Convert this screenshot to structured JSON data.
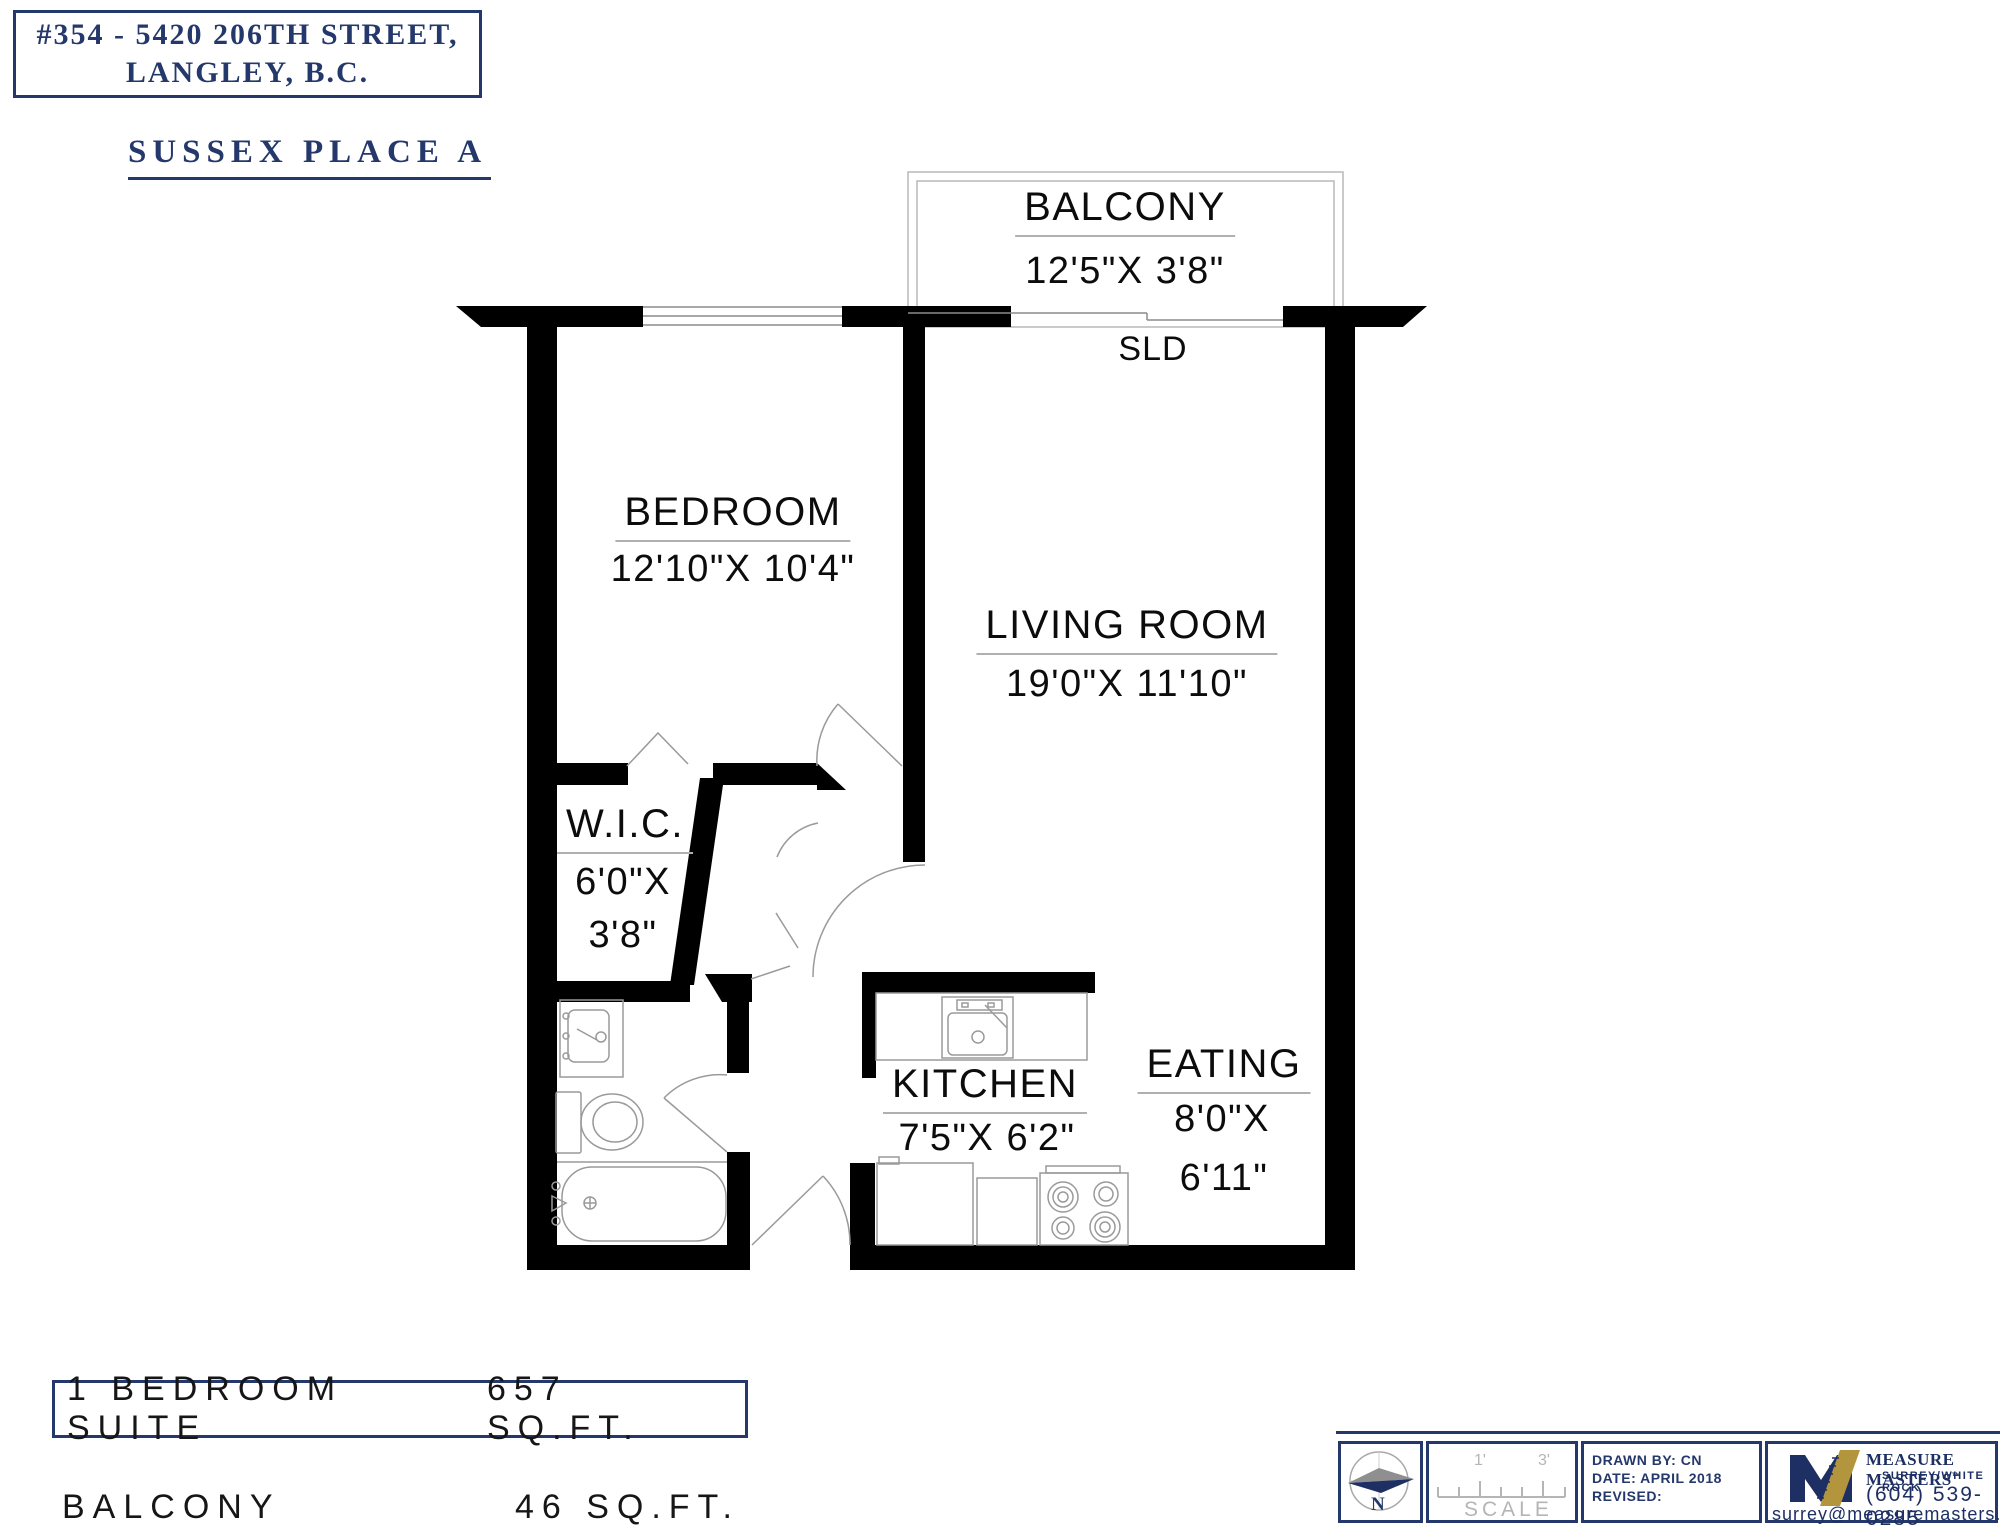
{
  "header": {
    "address_line1": "#354 - 5420 206TH STREET,",
    "address_line2": "LANGLEY, B.C.",
    "subtitle": "SUSSEX PLACE A"
  },
  "rooms": {
    "balcony": {
      "name": "BALCONY",
      "dims": "12'5\"X  3'8\""
    },
    "sld_label": "SLD",
    "bedroom": {
      "name": "BEDROOM",
      "dims": "12'10\"X  10'4\""
    },
    "living": {
      "name": "LIVING ROOM",
      "dims": "19'0\"X  11'10\""
    },
    "wic": {
      "name": "W.I.C.",
      "dims_line1": "6'0\"X",
      "dims_line2": "3'8\""
    },
    "kitchen": {
      "name": "KITCHEN",
      "dims": "7'5\"X  6'2\""
    },
    "eating": {
      "name": "EATING",
      "dims_line1": "8'0\"X",
      "dims_line2": "6'11\""
    }
  },
  "summary": {
    "suite_label": "1 BEDROOM SUITE",
    "suite_area": "657 SQ.FT.",
    "balcony_label": "BALCONY",
    "balcony_area": "46 SQ.FT."
  },
  "titleblock": {
    "compass_n": "N",
    "scale_tick1": "1'",
    "scale_tick2": "3'",
    "scale_label": "SCALE",
    "drawn_by": "DRAWN BY: CN",
    "date": "DATE: APRIL 2018",
    "revised": "REVISED:",
    "logo_name": "MEASURE MASTERS",
    "logo_tm": "™",
    "logo_sub": "SURREY/WHITE ROCK",
    "logo_phone": "(604) 539-0285",
    "logo_email": "surrey@measuremasters.ca"
  },
  "colors": {
    "navy": "#24386b",
    "logo_navy": "#1e2f63",
    "gold": "#b3953e",
    "wall": "#000000",
    "thin_line": "#9a9a9a"
  }
}
